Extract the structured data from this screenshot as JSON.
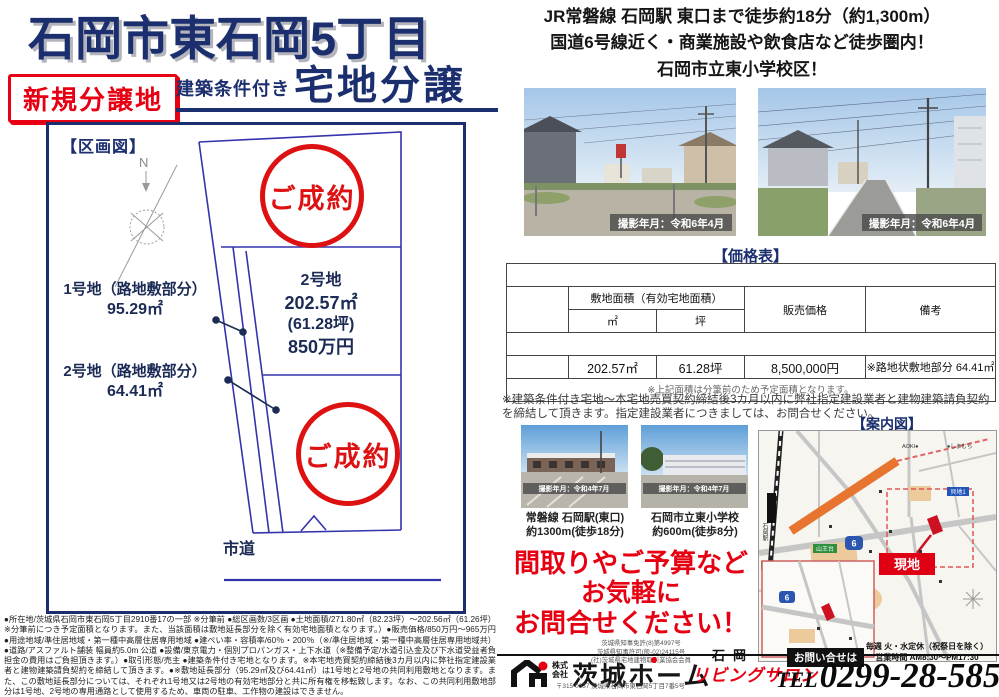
{
  "header": {
    "title": "石岡市東石岡5丁目",
    "badge": "新規分譲地",
    "cond_small": "建築条件付き",
    "cond_large": "宅地分譲"
  },
  "catch": {
    "line1": "JR常磐線 石岡駅 東口まで徒歩約18分（約1,300m）",
    "line2": "国道6号線近く・商業施設や飲食店など徒歩圏内！",
    "line3": "石岡市立東小学校区！"
  },
  "plan": {
    "heading": "【区画図】",
    "sold": "ご成約",
    "compass_n": "N",
    "lot1_label": "1号地（路地敷部分）",
    "lot1_area": "95.29㎡",
    "lot2s_label": "2号地（路地敷部分）",
    "lot2s_area": "64.41㎡",
    "lot2_name": "2号地",
    "lot2_m2": "202.57㎡",
    "lot2_tsubo": "(61.28坪)",
    "lot2_price": "850万円",
    "road": "市道"
  },
  "photos": {
    "cap1": "撮影年月：令和6年4月",
    "cap2": "撮影年月：令和6年4月"
  },
  "price": {
    "heading": "【価格表】",
    "title": "石岡市東石岡5丁目 建築条件付き 宅地分譲",
    "area_header": "敷地面積（有効宅地面積）",
    "m2": "㎡",
    "tsubo": "坪",
    "price_col": "販売価格",
    "note_col": "備考",
    "sold_msg1": "ご成約ありがとうございます",
    "sold_msg2": "ご成約ありがとうございます",
    "row_name": "2号棟",
    "row_m2": "202.57㎡",
    "row_tsubo": "61.28坪",
    "row_price": "8,500,000円",
    "row_note": "※路地状敷地部分 64.41㎡",
    "footnote": "※上記面積は分筆前のため予定面積となります。"
  },
  "terms": "※建築条件付き宅地～本宅地売買契約締結後3カ月以内に弊社指定建設業者と建物建築請負契約を締結して頂きます。指定建設業者につきましては、お問合せください。",
  "guide": {
    "heading": "【案内図】",
    "genchi": "現地",
    "station": "石岡駅",
    "route6": "6",
    "i1": "山王台",
    "i2": "国府4",
    "i3": "貝地1",
    "poi1": "AOKI●",
    "poi2": "●しまむら"
  },
  "access": {
    "p1_cap": "撮影年月：令和4年7月",
    "p1_l1": "常磐線 石岡駅(東口)",
    "p1_l2": "約1300m(徒歩18分)",
    "p2_cap": "撮影年月：令和4年7月",
    "p2_l1": "石岡市立東小学校",
    "p2_l2": "約600m(徒歩8分)"
  },
  "cta": {
    "l1": "間取りやご予算など",
    "l2": "お気軽に",
    "l3": "お問合せください！"
  },
  "footer": {
    "lic1": "茨城県知事免許(8)第4997号",
    "lic2": "茨城県知事許可(般-02)24115号",
    "lic3": "(社)茨城県宅地建物取引業協会会員",
    "corp1": "株式",
    "corp2": "会社",
    "company": "茨城ホーム",
    "addr": "〒315-0037 茨城県石岡市東石岡5丁目7番5号",
    "salon_city": "石岡",
    "salon": "リビングサロン",
    "ask": "お問い合せは",
    "hours1": "毎週 火・水定休（祝祭日を除く）",
    "hours2": "営業時間 AM8:30～PM17:30",
    "tel_label": "TEL",
    "tel": "0299-28-5858"
  },
  "fine_print": "●所在地/茨城県石岡市東石岡5丁目2910番17の一部 ※分筆前 ●総区画数/3区画 ●土地面積/271.80㎡（82.23坪）～202.56㎡（61.26坪）※分筆前につき予定面積となります。また、当該面積は敷地延長部分を除く有効宅地面積となります。）●販売価格/850万円～965万円 ●用途地域/準住居地域・第一種中高層住居専用地域 ●建ぺい率・容積率/60％・200％（※/準住居地域・第一種中高層住居専用地域共）●道路/アスファルト舗装 幅員約5.0m 公道 ●設備/東京電力・個別プロパンガス・上下水道（※整備予定/水道引込金及び下水道受益者負担金の費用はご負担頂きます。）●取引形態/売主 ●建築条件付き宅地となります。※本宅地売買契約締結後3カ月以内に弊社指定建設業者と建物建築請負契約を締結して頂きます。●※敷地延長部分（95.29㎡及び64.41㎡）は1号地と2号地の共同利用敷地となります。また、この敷地延長部分については、それぞれ1号地又は2号地の有効宅地部分と共に所有権を移転致します。なお、この共同利用敷地部分は1号地、2号地の専用通路として使用するため、車両の駐車、工作物の建設はできません。"
}
